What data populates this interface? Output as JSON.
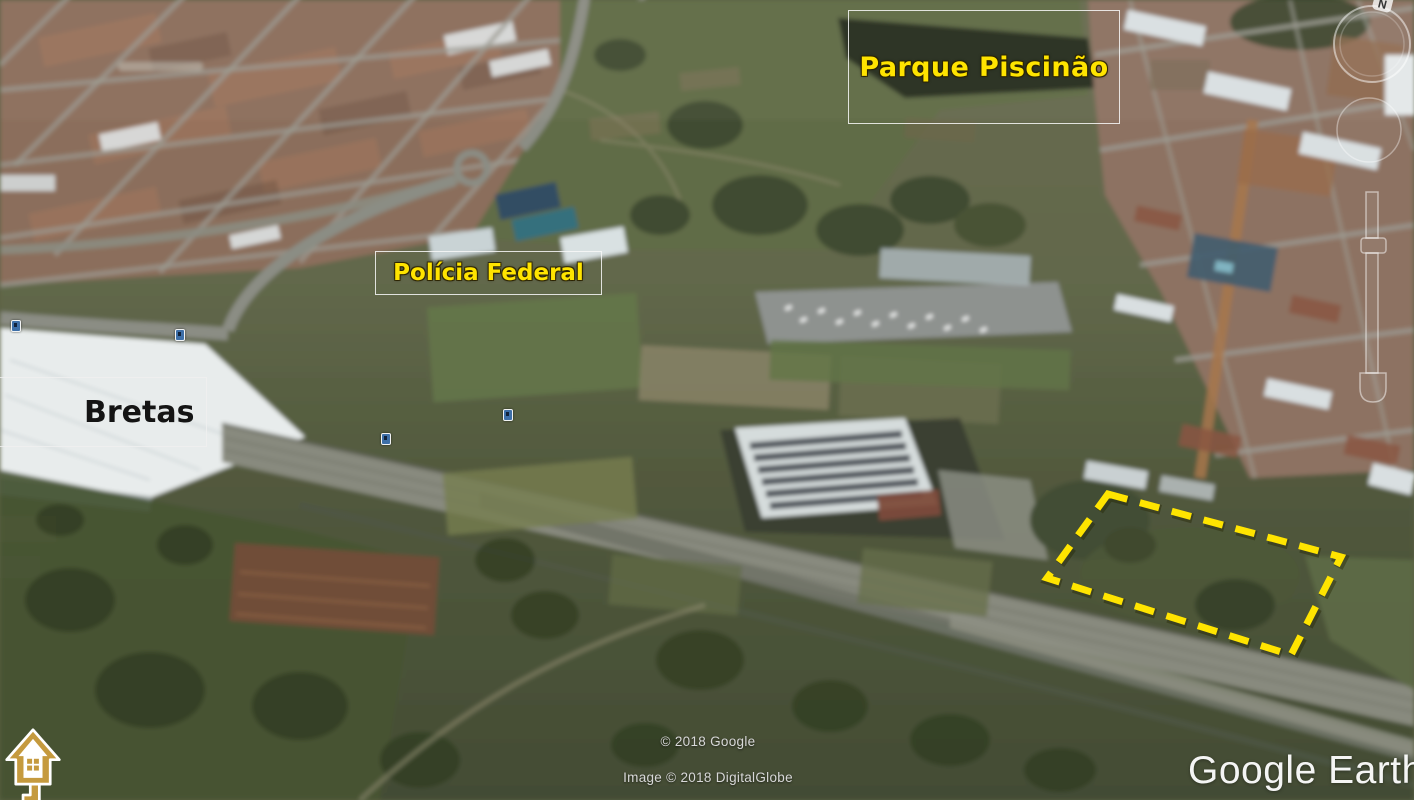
{
  "app": {
    "logo_text": "Google Earth"
  },
  "map": {
    "labels": {
      "parque_piscinao": "Parque Piscinão",
      "policia_federal": "Polícia Federal",
      "bretas": "Bretas"
    },
    "annotation_colors": {
      "highlight_yellow": "#ffe400",
      "label_dark": "#141414",
      "box_border": "#f8f8f8"
    },
    "property_outline": {
      "color": "#ffe400",
      "style": "dashed",
      "points": "1108,494 1341,557 1291,655 1047,578"
    }
  },
  "attribution": {
    "copyright_line": "© 2018 Google",
    "imagery_line": "Image © 2018 DigitalGlobe"
  },
  "navigation": {
    "compass_north_label": "N"
  },
  "branding": {
    "watermark_icon": "house-key-icon"
  }
}
